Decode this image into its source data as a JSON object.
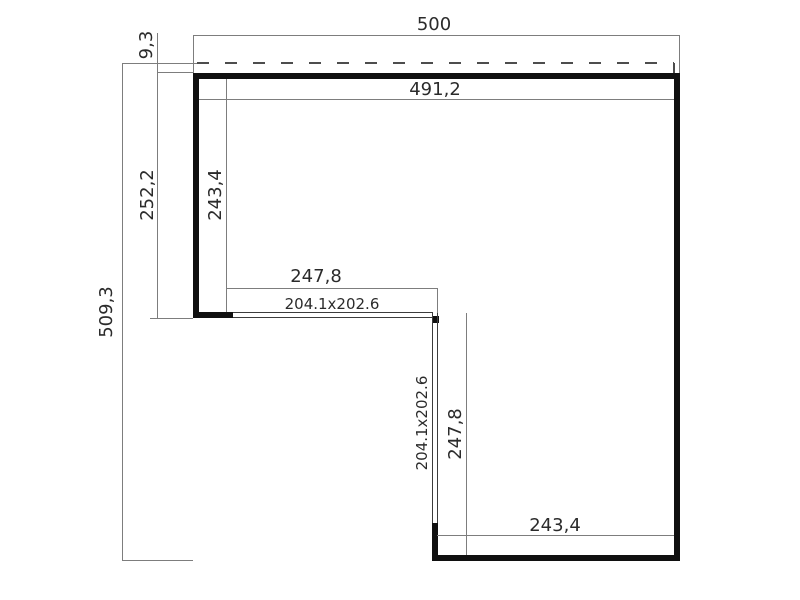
{
  "plan": {
    "type": "floor-plan",
    "shape": "L-shaped corner building, opening toward lower-left, two glazed door walls at the inner corner",
    "units_hint": "cm",
    "colors": {
      "background": "#ffffff",
      "wall": "#101010",
      "thin_line": "#7d7d7d",
      "glass_line": "#3c3c3c",
      "dash_line": "#4d4d4d",
      "text": "#2b2b2b"
    },
    "dimensions": {
      "overall_width": {
        "value": "500",
        "orientation": "horizontal",
        "position": "top, roof/overall width"
      },
      "roof_overhang": {
        "value": "9,3",
        "orientation": "vertical",
        "position": "top-left, roof edge to wall"
      },
      "inner_width": {
        "value": "491,2",
        "orientation": "horizontal",
        "position": "inside top wall"
      },
      "left_outer_depth": {
        "value": "252,2",
        "orientation": "vertical",
        "position": "left of left wing, outer"
      },
      "left_inner_depth": {
        "value": "243,4",
        "orientation": "vertical",
        "position": "inside left wing"
      },
      "overall_depth": {
        "value": "509,3",
        "orientation": "vertical",
        "position": "far left, overall depth"
      },
      "front_opening_width": {
        "value": "247,8",
        "orientation": "horizontal",
        "position": "above front glazed wall"
      },
      "front_door_size": {
        "value": "204.1x202.6",
        "orientation": "horizontal",
        "position": "front glazed door wall"
      },
      "side_door_size": {
        "value": "204.1x202.6",
        "orientation": "vertical",
        "position": "side glazed door wall"
      },
      "side_opening_depth": {
        "value": "247,8",
        "orientation": "vertical",
        "position": "right of side glazed wall"
      },
      "bottom_inner_width": {
        "value": "243,4",
        "orientation": "horizontal",
        "position": "inside bottom wall"
      }
    }
  }
}
